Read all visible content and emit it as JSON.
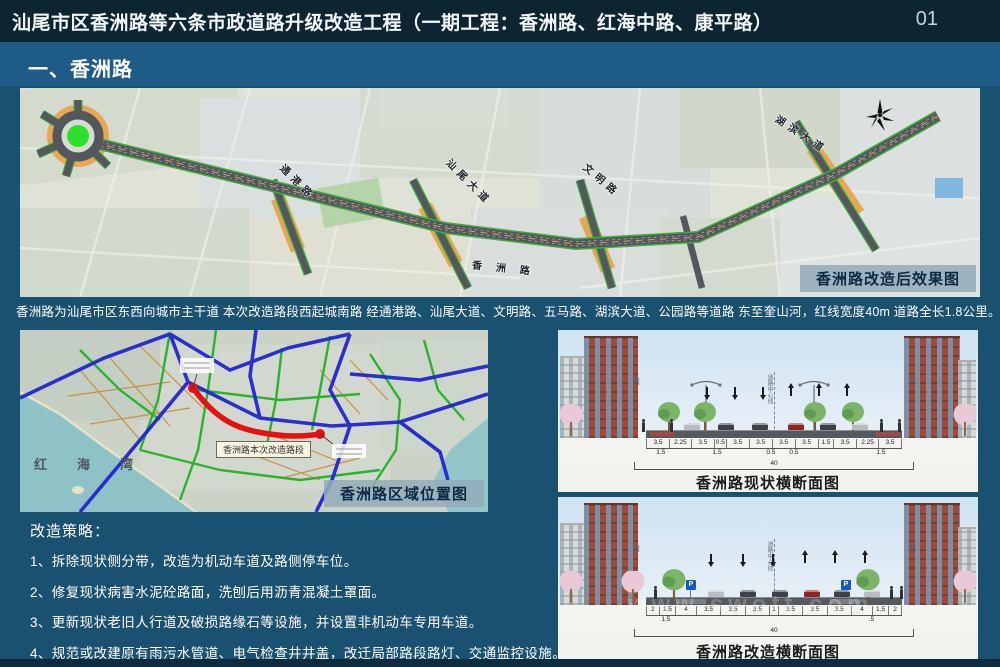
{
  "colors": {
    "header_bg": "#0d2431",
    "section_bg": "#1e5c87",
    "page_bg": "#1a5170",
    "accent_green": "#2ee02e",
    "road_red": "#e41212"
  },
  "header": {
    "title": "汕尾市区香洲路等六条市政道路升级改造工程（一期工程：香洲路、红海中路、康平路）",
    "page_number": "01"
  },
  "section_bar": {
    "label": "一、香洲路"
  },
  "effect_map": {
    "caption": "香洲路改造后效果图",
    "road_labels": {
      "tonggang": "通港路",
      "shanwei_avenue": "汕尾大道",
      "wenming": "文明路",
      "hubin_avenue": "湖滨大道",
      "xiangzhou": "香洲路"
    }
  },
  "description": "香洲路为汕尾市区东西向城市主干道 本次改造路段西起城南路 经通港路、汕尾大道、文明路、五马路、湖滨大道、公园路等道路 东至奎山河，红线宽度40m 道路全长1.8公里。",
  "location_map": {
    "caption": "香洲路区域位置图",
    "sea_label": "红海湾",
    "road_tag": "香洲路本次改造路段"
  },
  "strategies": {
    "title": "改造策略：",
    "items": [
      "1、拆除现状侧分带，改造为机动车道及路侧停车位。",
      "2、修复现状病害水泥砼路面，洗刨后用沥青混凝土罩面。",
      "3、更新现状老旧人行道及破损路缘石等设施，并设置非机动车专用车道。",
      "4、规范或改建原有雨污水管道、电气检查井井盖，改迁局部路段路灯、交通监控设施。"
    ]
  },
  "cross_sections": {
    "current": {
      "caption": "香洲路现状横断面图",
      "south": "南",
      "north": "北",
      "center_line": "道路中心线",
      "lane_labels": [
        "人行道",
        "树穴",
        "非机动车道",
        "侧分带",
        "绿化带",
        "机动车道",
        "机动车道",
        "机动车道",
        "机动车道",
        "绿化带",
        "侧分带",
        "非机动车道",
        "树穴",
        "人行道"
      ],
      "dims": [
        "3.5",
        "2.25",
        "3.5",
        "0.5",
        "3.5",
        "3.5",
        "3.5",
        "3.5",
        "1.5",
        "3.5",
        "2.25",
        "3.5"
      ],
      "sub_dims": [
        "1.5",
        "1.5",
        "0.5",
        "0.5",
        "1.5"
      ],
      "total": "40"
    },
    "proposed": {
      "caption": "香洲路改造横断面图",
      "south": "南",
      "north": "北",
      "center_line": "道路中心线",
      "parking_sign": "P",
      "lane_labels": [
        "人行道",
        "非机动车道",
        "树穴",
        "停车带",
        "机动车道",
        "机动车道",
        "机动车道",
        "机动车道",
        "机动车道",
        "机动车道",
        "停车带",
        "树穴",
        "非机动车道",
        "人行道"
      ],
      "dims": [
        "2",
        "1.5",
        "4",
        "3.5",
        "3.5",
        "3.5",
        "1",
        "3.5",
        "3.5",
        "3.5",
        "4",
        "1.5",
        "2"
      ],
      "sub_dims": [
        "1.5",
        ".5"
      ],
      "total": "40"
    }
  },
  "watermark": "www.swott.com"
}
